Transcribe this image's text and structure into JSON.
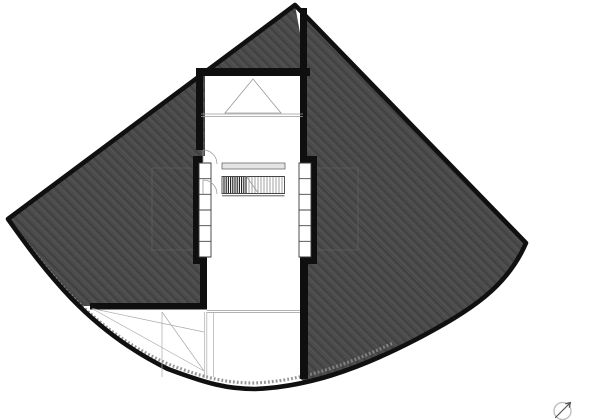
{
  "meta": {
    "type": "architectural-floor-plan",
    "description": "Black-and-white roof-level plan of a fan/kite-shaped house: hatched dark roof panels around a white central stair corridor, curved eave at the bottom, north-arrow symbol at lower right",
    "visible_text": []
  },
  "colors": {
    "background": "#ffffff",
    "roof_hatch_base": "#474747",
    "roof_hatch_light": "#535353",
    "roof_hatch_dark": "#3c3c3c",
    "outline_black": "#101010",
    "wall_black": "#0f0f0f",
    "thin_line_gray": "#9a9a9a",
    "construction_gray": "#ababab"
  },
  "icons": {
    "north_arrow": "north-arrow-icon"
  },
  "drawing": {
    "paths": {
      "background": "M0 0H610V420H0Z",
      "outline": "M295 5L8 219C45 271 88 330 168 369C208 384 228 389 255 389C305 387 355 371 415 340C472 310 507 287 526 243Z",
      "roof_left": "M295 5L8 219C40 264 62 292 80 306L205 306V264H193V156H205V72Z",
      "roof_right": "M295 5L526 243C507 287 472 310 415 340C355 371 303 386 301 379V264H317V156H301V10Z",
      "roof_top": "M295 5L205 72H307Z",
      "dormer_faint": "M152 168H200V250H152ZM310 168H358V250H310Z",
      "eaves_band": "M14 226C50 274 92 330 168 364C207 379 228 383 255 383C298 381 340 368 393 343",
      "walls": "M200 68H310V76H200ZM196 68H203V150H196ZM300 8H307V163H300ZM193 156H203V163H193ZM307 156H317V163H307ZM193 156H200V264H193ZM310 156H317V264H310ZM193 257H207V264H193ZM301 257H317V264H301ZM200 257H207V309H200ZM300 257H308V379H300ZM90 303H207V309.5H90Z",
      "cells": "M199 163H211V257H199ZM299 163H311V257H299Z",
      "cell_dividers": "M199 178.7H211M199 194.3H211M199 210H211M199 225.7H211M199 241.3H211M299 178.7H311M299 194.3H311M299 210H311M299 225.7H311M299 241.3H311",
      "handrail": "M222 163H285V169H222Z",
      "stair_outline": "M222 176.5H284.5V193.5H222ZM222 195.8H284.5",
      "treads_dense": "M224 177V193M226.2 177V193M228.4 177V193M230.6 177V193M232.8 177V193M235 177V193M237.2 177V193M239.4 177V193M241.6 177V193M243.8 177V193M246 177V193",
      "treads_light": "M249 177V193M252 177V193M255 177V193M258 177V193M261 177V193M264 177V193M267 177V193M270 177V193M273 177V193M276 177V193M279 177V193M282 177V193",
      "break_line": "M246.5 176.5L258.5 193.5",
      "door_arcs": "M203 150V164M203 150A14 14 0 0 1 217 164M203 180V194M203 180A14 14 0 0 1 217 194",
      "skylight_triangle": "M253 79L281 113H225Z",
      "level_lines": "M201 114H303M201 116.4H303M207 310.6H300M207 312.6H300",
      "construction_lines": "M92 308.5L204 371M162 312L204 371M92 308.5L204 332M204.7 312V378M206.8 312V378M213.5 312V377M162 312V377",
      "north_circle": "M554 411a8.5 8.5 0 1 0 17 0a8.5 8.5 0 1 0 -17 0",
      "north_needle": "M555.5 417.5L570.5 402.5M570.5 402.5L565.8 403.6M570.5 402.5L569.4 407.2"
    }
  }
}
